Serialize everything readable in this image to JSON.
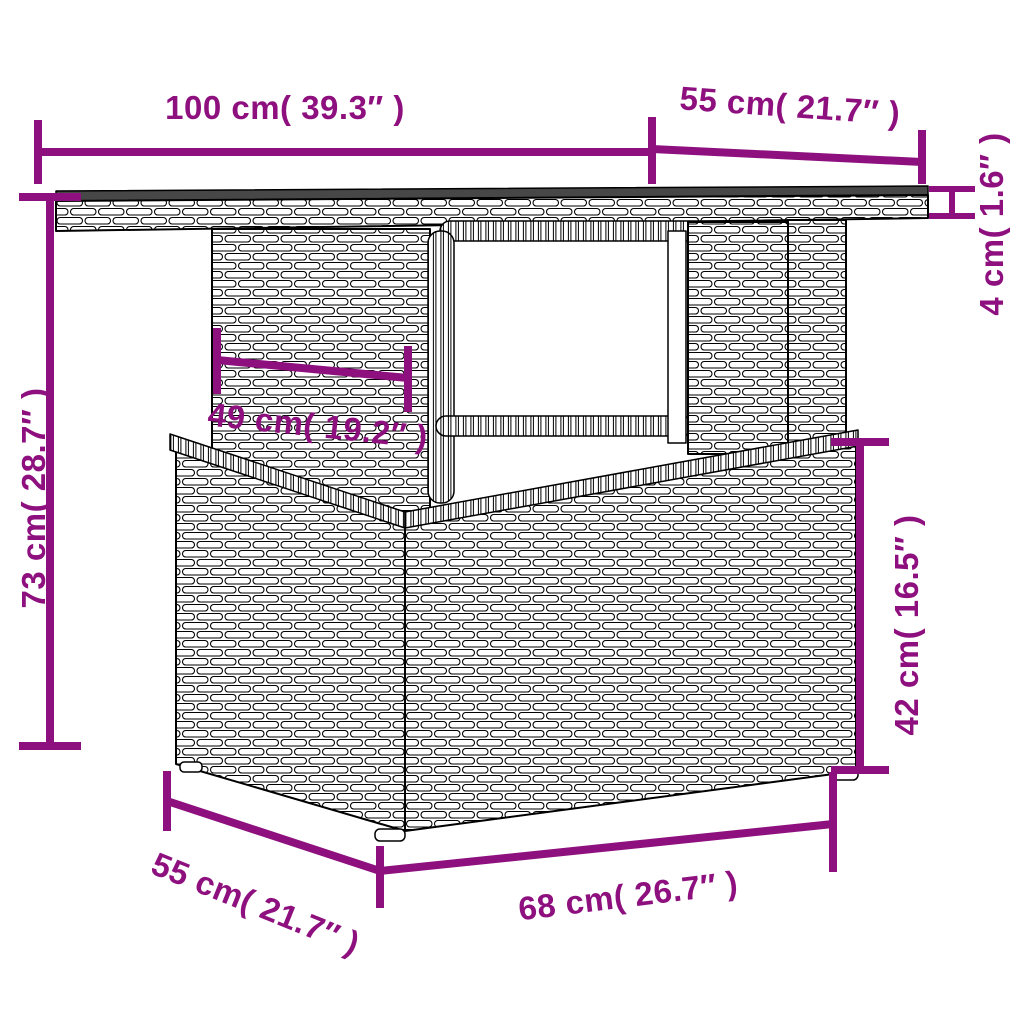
{
  "diagram": {
    "kind": "furniture-dimension-diagram",
    "subject": "poly rattan garden table with storage base, black-and-white line drawing with purple dimension arrows",
    "colors": {
      "accent": "#8E107F",
      "outline": "#000000",
      "tabletop_surface": "#474747",
      "background": "#FFFFFF"
    },
    "labels": {
      "tabletop_width": "100 cm( 39.3″ )",
      "tabletop_depth": "55 cm( 21.7″ )",
      "tabletop_thickness": "4 cm( 1.6″ )",
      "overall_height": "73 cm( 28.7″ )",
      "column_width": "49 cm( 19.2″ )",
      "base_height": "42 cm( 16.5″ )",
      "base_depth": "55 cm( 21.7″ )",
      "base_width": "68 cm( 26.7″ )"
    }
  }
}
